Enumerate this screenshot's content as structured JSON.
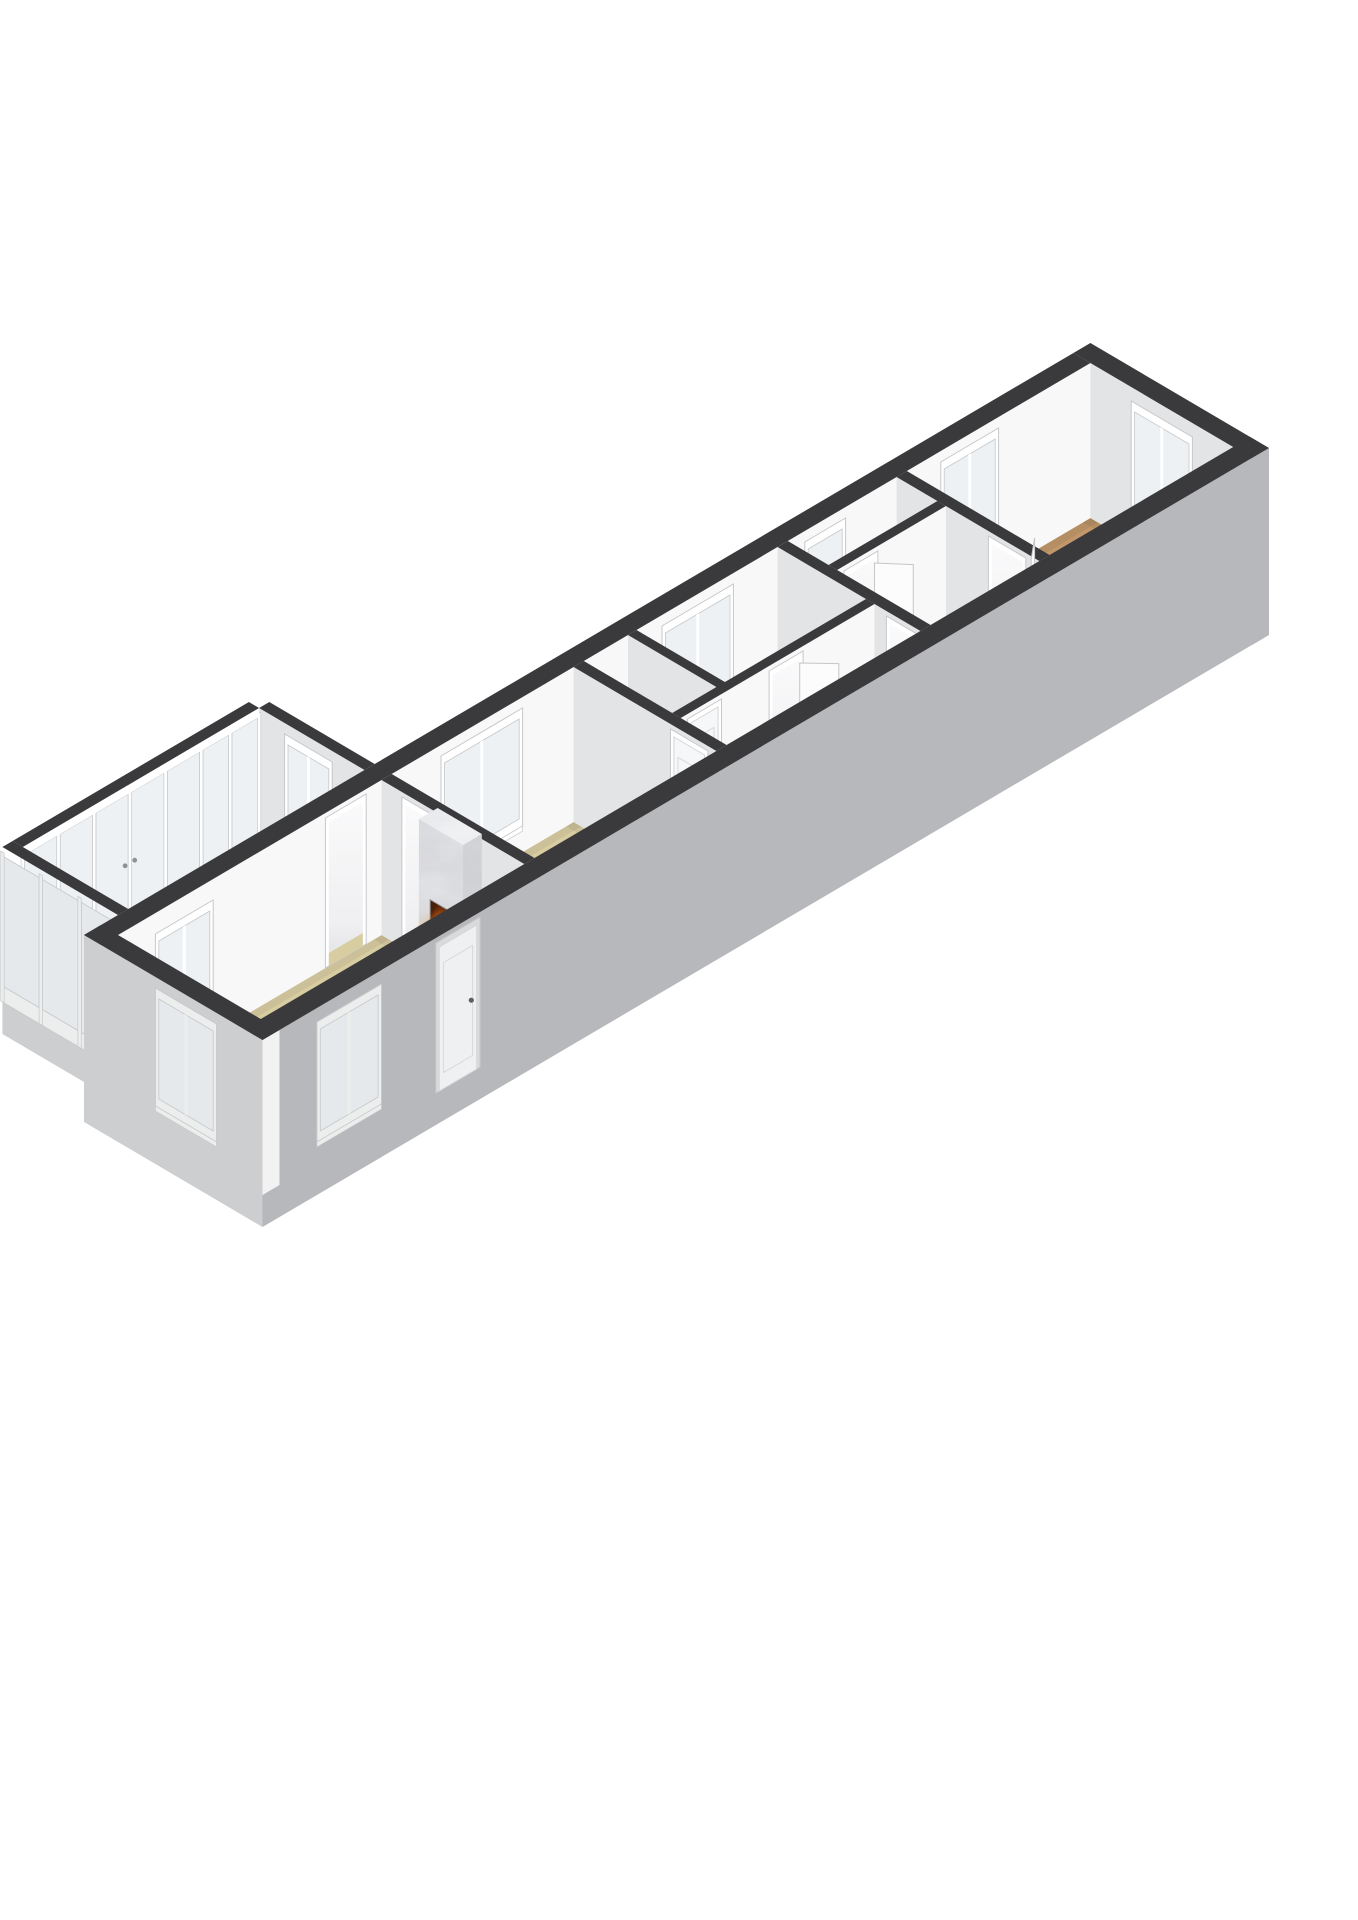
{
  "meta": {
    "kind": "3d-floorplan-render",
    "description": "Axonometric 3D floor plan of a long narrow apartment on a white background, no text labels",
    "rooms": [
      {
        "name": "sunroom",
        "floor": "tan",
        "features": [
          "full-height-glazing",
          "french-doors"
        ]
      },
      {
        "name": "living-room",
        "floor": "tan",
        "features": [
          "marble-fireplace-with-fire",
          "exterior-window",
          "front-door",
          "interior-window-to-sunroom",
          "passage-to-sunroom"
        ]
      },
      {
        "name": "bedroom-a",
        "floor": "tan",
        "features": [
          "window-nw",
          "door-to-hall"
        ]
      },
      {
        "name": "closet",
        "floor": "white",
        "features": [
          "door"
        ]
      },
      {
        "name": "bedroom-b",
        "floor": "tan",
        "features": [
          "window-nw",
          "door-ajar"
        ]
      },
      {
        "name": "hallway",
        "floor": "white",
        "features": []
      },
      {
        "name": "rear-hall",
        "floor": "white",
        "features": [
          "small-window"
        ]
      },
      {
        "name": "bathroom",
        "floor": "white",
        "features": [
          "shower-tray",
          "door-ajar"
        ]
      },
      {
        "name": "bedroom-c",
        "floor": "brown",
        "features": [
          "window-end-wall",
          "window-nw",
          "door-ajar"
        ]
      }
    ]
  },
  "canvas": {
    "width": 1358,
    "height": 1920
  },
  "projection": {
    "A": 34,
    "B": 20,
    "H": 155,
    "plinth": 32,
    "ox": 118,
    "oy": 1090
  },
  "palette": {
    "bg": "#ffffff",
    "wallTop": "#3a3a3c",
    "faceSE": "#f8f8f9",
    "faceSW": "#e3e4e6",
    "cap": "#f2f2f3",
    "outerSE": "#b7b8bb",
    "outerSW": "#cdcecf",
    "frame": "#ffffff",
    "frameOut": "#eceded",
    "frameLine": "#c6c8ca",
    "glass": "#edf1f3",
    "glassOut": "#e6e9eb",
    "tan": "#d8cda1",
    "white": "#f1f1f2",
    "brown": "#c1976b",
    "marbleLight": "#eff0f2",
    "marbleMid": "#e4e5e8",
    "marbleDark": "#d7d8db",
    "ember": "#ff8d1f",
    "flame": "#ffb640",
    "flameCore": "#ffd36e",
    "log": "#3a2013",
    "leaf": "#fcfcfd",
    "handle": "#8f9194",
    "ao": "#000000"
  },
  "scene": [
    {
      "t": "floor",
      "name": "sunroom",
      "rect": [
        0.8,
        -3.6,
        7.75,
        -0.5
      ],
      "color": "tan"
    },
    {
      "t": "wallV",
      "name": "sunroom-ne-wall",
      "x0": 7.75,
      "x1": 8.05,
      "y0": -3.6,
      "y1": -0.5,
      "ext": false,
      "feat": [
        {
          "k": "win",
          "a0": -2.75,
          "a1": -1.55,
          "z0": 35,
          "z1": 135,
          "panes": 2
        }
      ]
    },
    {
      "t": "glzU",
      "name": "sunroom-glazed-nw-wall",
      "x0": 0.8,
      "x1": 7.75,
      "y0": -3.9,
      "y1": -3.6,
      "divs": [
        0.8,
        1.85,
        2.9,
        3.95,
        5.0,
        6.05,
        6.9,
        7.75
      ],
      "doorIdx": [
        2,
        3
      ]
    },
    {
      "t": "glzV",
      "name": "sunroom-glazed-sw-wall",
      "x0": 0.5,
      "x1": 0.8,
      "y0": -3.9,
      "y1": -0.5,
      "divs": [
        -3.9,
        -2.77,
        -1.63,
        -0.5
      ],
      "doorIdx": []
    },
    {
      "t": "floor",
      "name": "bedroom-c",
      "rect": [
        23.2,
        0,
        28.6,
        4.2
      ],
      "color": "brown"
    },
    {
      "t": "floor",
      "name": "bathroom",
      "rect": [
        19.7,
        1.45,
        22.9,
        4.2
      ],
      "color": "white"
    },
    {
      "t": "shower",
      "name": "shower-tray",
      "rect": [
        21.6,
        2.95,
        22.75,
        4.1
      ]
    },
    {
      "t": "floor",
      "name": "rear-hall",
      "rect": [
        19.7,
        0,
        22.9,
        1.2
      ],
      "color": "white"
    },
    {
      "t": "floor",
      "name": "bedroom-b",
      "rect": [
        15.25,
        0,
        19.4,
        2.6
      ],
      "color": "tan"
    },
    {
      "t": "floor",
      "name": "closet",
      "rect": [
        13.7,
        0,
        15.0,
        2.6
      ],
      "color": "white"
    },
    {
      "t": "floor",
      "name": "hallway",
      "rect": [
        13.7,
        2.85,
        19.4,
        4.2
      ],
      "color": "white"
    },
    {
      "t": "floor",
      "name": "bedroom-a",
      "rect": [
        8.05,
        0,
        13.4,
        4.2
      ],
      "color": "tan"
    },
    {
      "t": "floor",
      "name": "living-room",
      "rect": [
        0,
        0,
        7.75,
        4.2
      ],
      "color": "tan"
    },
    {
      "t": "wallV",
      "name": "ne-end-wall",
      "x0": 28.6,
      "x1": 29.1,
      "y0": -0.5,
      "y1": 4.75,
      "ext": false,
      "capExt": true,
      "feat": [
        {
          "k": "win",
          "a0": 1.3,
          "a1": 2.9,
          "z0": 35,
          "z1": 132,
          "panes": 2
        }
      ]
    },
    {
      "t": "wallU",
      "name": "nw-long-wall",
      "x0": -0.5,
      "x1": 28.6,
      "y0": -0.5,
      "y1": 0,
      "ext": false,
      "feat": [
        {
          "k": "win",
          "a0": 1.2,
          "a1": 2.7,
          "z0": 30,
          "z1": 125,
          "panes": 2
        },
        {
          "k": "open",
          "a0": 6.2,
          "a1": 7.2,
          "floor": "tan"
        },
        {
          "k": "win",
          "a0": 9.6,
          "a1": 11.8,
          "z0": 35,
          "z1": 135,
          "panes": 2
        },
        {
          "k": "win",
          "a0": 16.1,
          "a1": 18.0,
          "z0": 35,
          "z1": 135,
          "panes": 2
        },
        {
          "k": "win",
          "a0": 20.3,
          "a1": 21.3,
          "z0": 35,
          "z1": 135,
          "panes": 1
        },
        {
          "k": "win",
          "a0": 24.3,
          "a1": 25.8,
          "z0": 35,
          "z1": 135,
          "panes": 2
        }
      ]
    },
    {
      "t": "wallV",
      "name": "bath-bedroom-c-wall",
      "x0": 22.9,
      "x1": 23.2,
      "y0": 0,
      "y1": 4.2,
      "ext": false,
      "capExt": false,
      "feat": [
        {
          "k": "open",
          "a0": 2.8,
          "a1": 3.7,
          "floor": "brown"
        }
      ]
    },
    {
      "t": "leaf",
      "name": "door-leaf-bedroom-c",
      "p0": [
        23.2,
        3.66
      ],
      "p1": [
        23.78,
        3.18
      ]
    },
    {
      "t": "wallU",
      "name": "rearhall-bath-wall",
      "x0": 19.7,
      "x1": 22.9,
      "y0": 1.2,
      "y1": 1.45,
      "ext": false,
      "feat": [
        {
          "k": "open",
          "a0": 20.0,
          "a1": 20.8,
          "floor": "white"
        }
      ]
    },
    {
      "t": "leaf",
      "name": "door-leaf-bathroom",
      "p0": [
        20.8,
        1.45
      ],
      "p1": [
        21.33,
        2.06
      ]
    },
    {
      "t": "wallV",
      "name": "bedb-rearhall-wall",
      "x0": 19.4,
      "x1": 19.7,
      "y0": 0,
      "y1": 4.2,
      "ext": false,
      "feat": [
        {
          "k": "open",
          "a0": 3.3,
          "a1": 4.15,
          "floor": "white"
        }
      ]
    },
    {
      "t": "wallV",
      "name": "closet-bedb-wall",
      "x0": 15.0,
      "x1": 15.25,
      "y0": 0,
      "y1": 2.85,
      "ext": false,
      "feat": []
    },
    {
      "t": "wallU",
      "name": "hallway-nw-wall",
      "x0": 13.7,
      "x1": 19.4,
      "y0": 2.6,
      "y1": 2.85,
      "ext": false,
      "feat": [
        {
          "k": "doorp",
          "a0": 14.0,
          "a1": 14.8
        },
        {
          "k": "open",
          "a0": 16.4,
          "a1": 17.2,
          "floor": "tan"
        }
      ]
    },
    {
      "t": "leaf",
      "name": "door-leaf-bedroom-b",
      "p0": [
        17.2,
        2.85
      ],
      "p1": [
        17.76,
        3.44
      ]
    },
    {
      "t": "wallV",
      "name": "beda-hall-wall",
      "x0": 13.4,
      "x1": 13.7,
      "y0": 0,
      "y1": 4.2,
      "ext": false,
      "feat": [
        {
          "k": "doorp",
          "a0": 2.95,
          "a1": 3.85
        }
      ]
    },
    {
      "t": "wallV",
      "name": "living-beda-wall",
      "x0": 7.75,
      "x1": 8.05,
      "y0": 0,
      "y1": 4.2,
      "ext": false,
      "feat": [
        {
          "k": "open",
          "a0": 0.7,
          "a1": 1.7,
          "floor": "tan"
        }
      ]
    },
    {
      "t": "fireplace",
      "name": "fireplace",
      "hearth": [
        7.0,
        1.5,
        7.75,
        3.1
      ],
      "hearthH": 12,
      "col": [
        7.2,
        1.65,
        7.75,
        2.95
      ],
      "z0": 12,
      "z1": 160,
      "box": {
        "a0": 1.98,
        "a1": 2.62,
        "z0": 26,
        "z1": 86
      }
    },
    {
      "t": "wallU",
      "name": "se-long-wall",
      "x0": -0.5,
      "x1": 29.1,
      "y0": 4.2,
      "y1": 4.75,
      "ext": true,
      "feat": [
        {
          "k": "win",
          "a0": 1.2,
          "a1": 2.9,
          "z0": 30,
          "z1": 132,
          "panes": 2,
          "out": true
        },
        {
          "k": "doorp",
          "a0": 4.7,
          "a1": 5.8,
          "out": true
        }
      ]
    },
    {
      "t": "wallV",
      "name": "sw-end-wall",
      "x0": -0.5,
      "x1": 0,
      "y0": -0.5,
      "y1": 4.75,
      "ext": true,
      "feat": [
        {
          "k": "win",
          "a0": 1.7,
          "a1": 3.3,
          "z0": 35,
          "z1": 135,
          "panes": 2,
          "out": true
        }
      ]
    }
  ]
}
